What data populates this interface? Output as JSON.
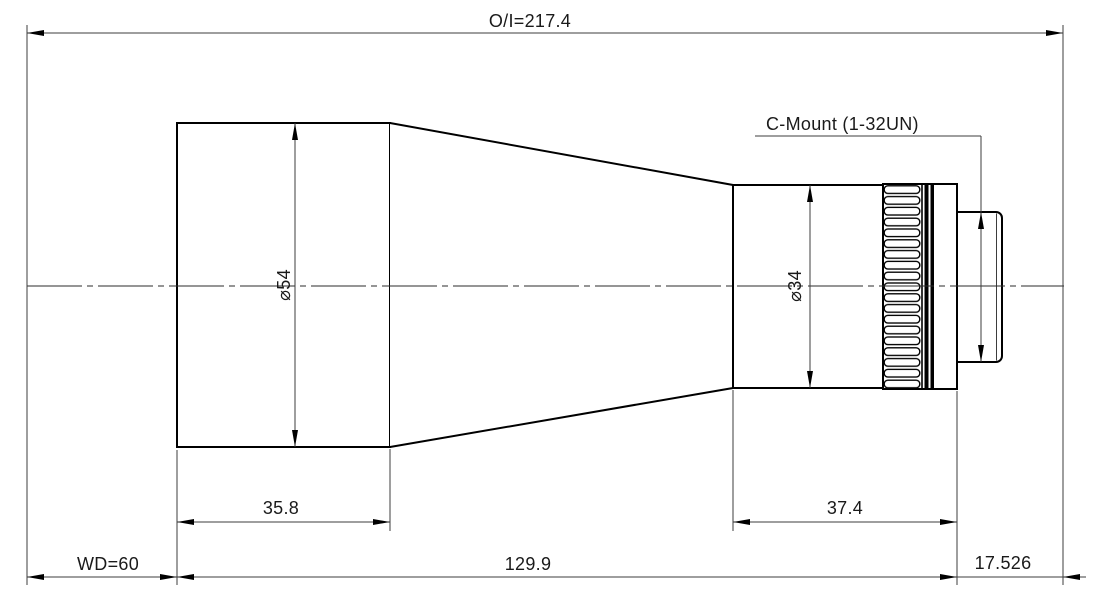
{
  "drawing": {
    "type": "lens-mechanical-dimension-drawing",
    "colors": {
      "background": "#ffffff",
      "outline": "#000000",
      "dimension_lines": "#3d3d3d",
      "text": "#1a1a1a"
    },
    "labels": {
      "overall_length": "O/I=217.4",
      "mount": "C-Mount (1-32UN)",
      "front_diameter": "⌀54",
      "rear_diameter": "⌀34",
      "front_barrel_length": "35.8",
      "rear_barrel_length": "37.4",
      "working_distance": "WD=60",
      "mid_length": "129.9",
      "flange_focal_distance": "17.526"
    }
  }
}
